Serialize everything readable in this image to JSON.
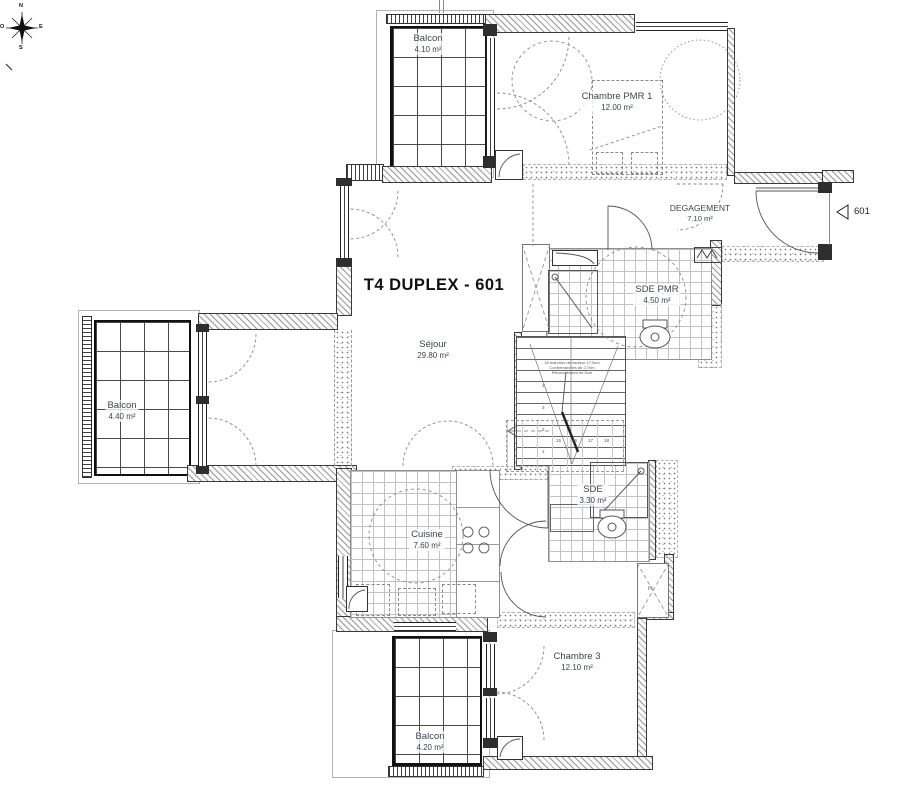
{
  "title": "T4 DUPLEX - 601",
  "unit_marker": {
    "label": "601"
  },
  "compass": {
    "n": "N",
    "e": "E",
    "s": "S",
    "o": "O"
  },
  "rooms": {
    "balcon_top": {
      "name": "Balcon",
      "area": "4.10 m²"
    },
    "chambre_pmr1": {
      "name": "Chambre PMR 1",
      "area": "12.00 m²"
    },
    "degagement": {
      "name": "DEGAGEMENT",
      "area": "7.10 m²"
    },
    "sde_pmr": {
      "name": "SDE PMR",
      "area": "4.50 m²"
    },
    "sejour": {
      "name": "Séjour",
      "area": "29.80 m²"
    },
    "balcon_left": {
      "name": "Balcon",
      "area": "4.40 m²"
    },
    "cuisine": {
      "name": "Cuisine",
      "area": "7.60 m²"
    },
    "sde": {
      "name": "SDE",
      "area": "3.30 m²"
    },
    "chambre_3": {
      "name": "Chambre 3",
      "area": "12.10 m²"
    },
    "balcon_bottom": {
      "name": "Balcon",
      "area": "4.20 m²"
    }
  },
  "stairs": {
    "note": [
      "18 marches de hauteur 17,5cm",
      "Contremarches de 2,70m",
      "Recouvrement de 5cm"
    ],
    "numbers": [
      "1",
      "2",
      "3",
      "4",
      "15",
      "16",
      "17",
      "18"
    ],
    "closet_label": "PL"
  },
  "colors": {
    "wall_line": "#333333",
    "hatch": "#9a9a9a",
    "label_text": "#3d4451",
    "title_text": "#111111"
  }
}
